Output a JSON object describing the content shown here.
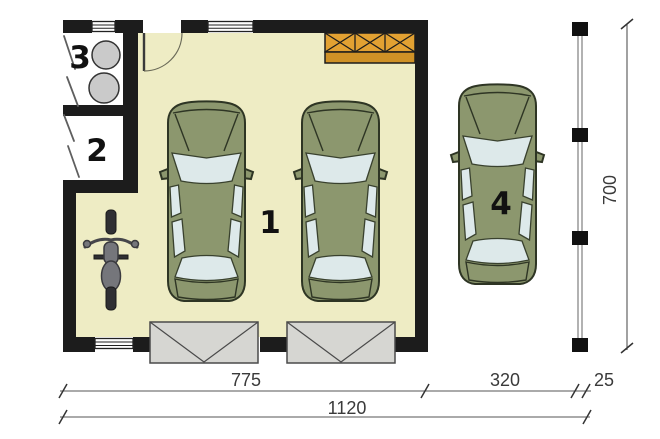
{
  "labels": {
    "garage": "1",
    "storage_room": "2",
    "utility_room": "3",
    "carport_space": "4"
  },
  "dimensions": {
    "building_width": "775",
    "carport_width": "320",
    "post_depth": "25",
    "total_width": "1120",
    "total_depth": "700"
  },
  "colors": {
    "floor": "#eeecc4",
    "wall": "#1c1c1c",
    "car_body": "#8c976e",
    "glass": "#dde9ea",
    "workbench": "#e2a132",
    "workbench_dark": "#cf9126",
    "apron": "#d6d6d2",
    "tank": "#cacaca",
    "motorcycle": "#75767b"
  }
}
